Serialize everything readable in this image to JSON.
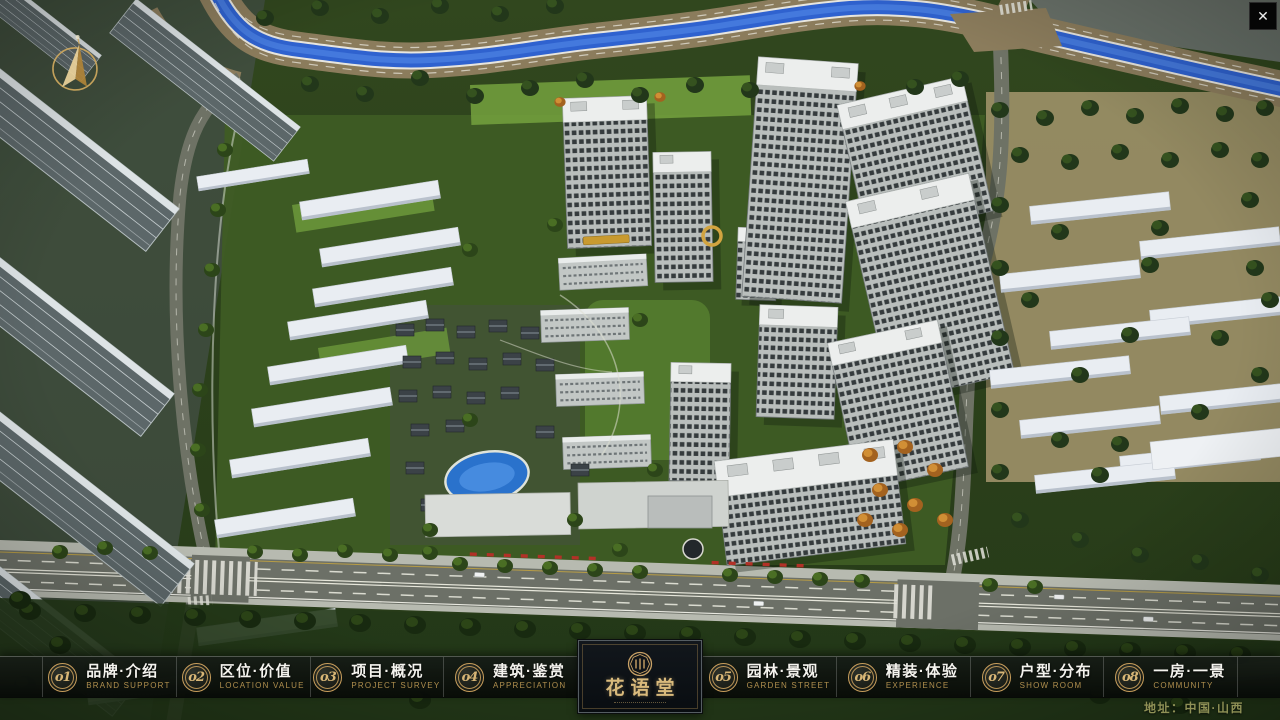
{
  "theme": {
    "accent_gold": "#c89e5c",
    "number_gold": "#d8b676",
    "en_label_gold": "#b08f4e",
    "zh_label_white": "#f4f3ee",
    "address_olive": "#8f9156",
    "bar_background": "#0c100c",
    "logo_panel_background": "#0b1014",
    "river_blue": "#2f62cf",
    "canopy_green": "#33491f"
  },
  "icons": {
    "close": "✕",
    "compass": "gold-compass-arrow",
    "logo_seal": "round-gold-seal"
  },
  "menu": {
    "items": [
      {
        "num": "o1",
        "zh": "品牌·介绍",
        "en": "BRAND SUPPORT"
      },
      {
        "num": "o2",
        "zh": "区位·价值",
        "en": "LOCATION VALUE"
      },
      {
        "num": "o3",
        "zh": "项目·概况",
        "en": "PROJECT SURVEY"
      },
      {
        "num": "o4",
        "zh": "建筑·鉴赏",
        "en": "APPRECIATION"
      },
      {
        "num": "o5",
        "zh": "园林·景观",
        "en": "GARDEN STREET"
      },
      {
        "num": "o6",
        "zh": "精装·体验",
        "en": "EXPERIENCE"
      },
      {
        "num": "o7",
        "zh": "户型·分布",
        "en": "SHOW ROOM"
      },
      {
        "num": "o8",
        "zh": "一房·一景",
        "en": "COMMUNITY"
      }
    ]
  },
  "logo": {
    "title": "花语堂"
  },
  "footer": {
    "address": "地址：中国·山西"
  }
}
